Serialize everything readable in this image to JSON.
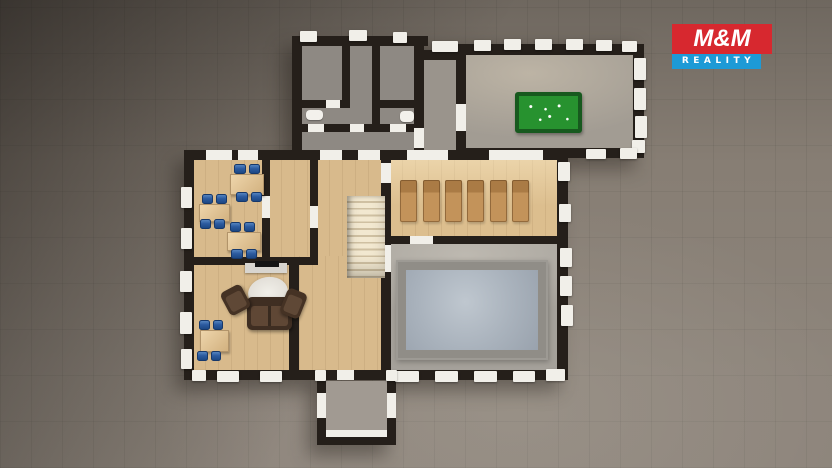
{
  "logo": {
    "top_text": "M&M",
    "bottom_text": "REALITY"
  },
  "colors": {
    "ground": "#877e74",
    "wall": "#251f1a",
    "cap": "#f1efe9",
    "wood": "#d8ba8c",
    "gray_floor": "#948e87",
    "deck": "#a5a19a",
    "water": "#a9b2bc",
    "felt_green": "#27922f",
    "chair_blue": "#1c4884",
    "lounger": "#c3935a",
    "sofa": "#3f2e22",
    "logo_red": "#d7282f",
    "logo_blue": "#1d9ad6"
  },
  "scene": {
    "type": "3d-floorplan-top-down-render",
    "visible_objects": [
      "billiard-table",
      "staircase",
      "swimming-pool",
      "loungers-x6",
      "office-desks-with-blue-chairs",
      "sofa-set-with-rug-and-tv",
      "entrance-vestibule",
      "utility-rooms"
    ]
  }
}
